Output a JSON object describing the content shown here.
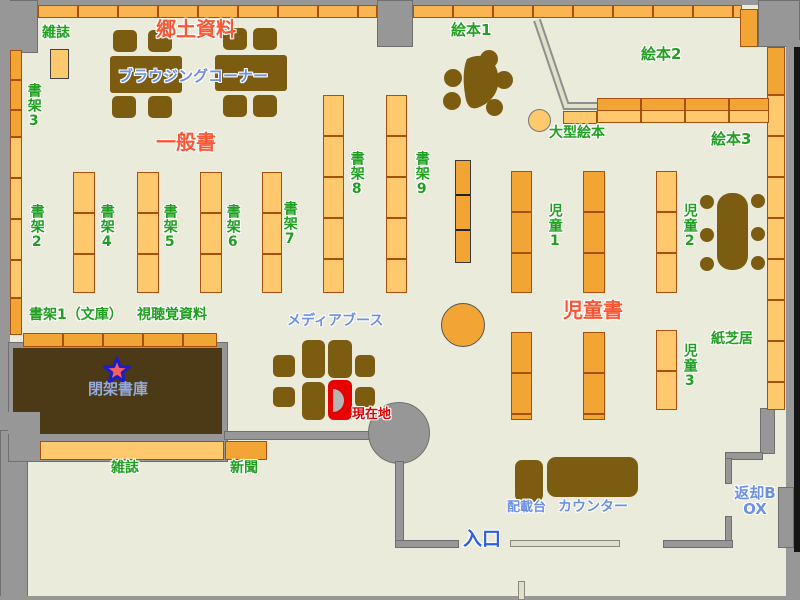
{
  "labels": {
    "magazine_top": "雑誌",
    "local_history": "郷土資料",
    "browsing_corner": "ブラウジングコーナー",
    "picture_book1": "絵本1",
    "picture_book2": "絵本2",
    "picture_book3": "絵本3",
    "large_picture_book": "大型絵本",
    "shelf2": "書架2",
    "shelf3": "書架3",
    "shelf4": "書架4",
    "shelf5": "書架5",
    "shelf6": "書架6",
    "shelf7": "書架7",
    "shelf8": "書架8",
    "shelf9": "書架9",
    "general_books": "一般書",
    "children1": "児童1",
    "children2": "児童2",
    "children3": "児童3",
    "children_books": "児童書",
    "kamishibai": "紙芝居",
    "shelf1_bunko": "書架1（文庫）",
    "audiovisual": "視聴覚資料",
    "closed_stacks": "閉架書庫",
    "media_booth": "メディアブース",
    "current_location": "現在地",
    "magazine_bottom": "雑誌",
    "newspaper": "新聞",
    "entrance": "入口",
    "distribution_table": "配載台",
    "counter": "カウンター",
    "return_box": "返却BOX"
  },
  "colors": {
    "floor": "#EBEBDB",
    "wall": "#979797",
    "wall_border": "#6F6F6F",
    "shelf_light": "#FDC96C",
    "shelf_mid": "#F8B551",
    "shelf_dark": "#F2A434",
    "shelf_border": "#A8500F",
    "table_brown": "#7B5C10",
    "dark_room": "#4C3916",
    "door_beige": "#E2E0C4",
    "label_green": "#1FA01F",
    "label_red": "#FF5533",
    "label_blue": "#2F5FE8",
    "label_lightblue": "#6C8FE8",
    "closed_label": "#95ABDE",
    "current_red": "#E00000",
    "marker_red": "#E60000"
  }
}
